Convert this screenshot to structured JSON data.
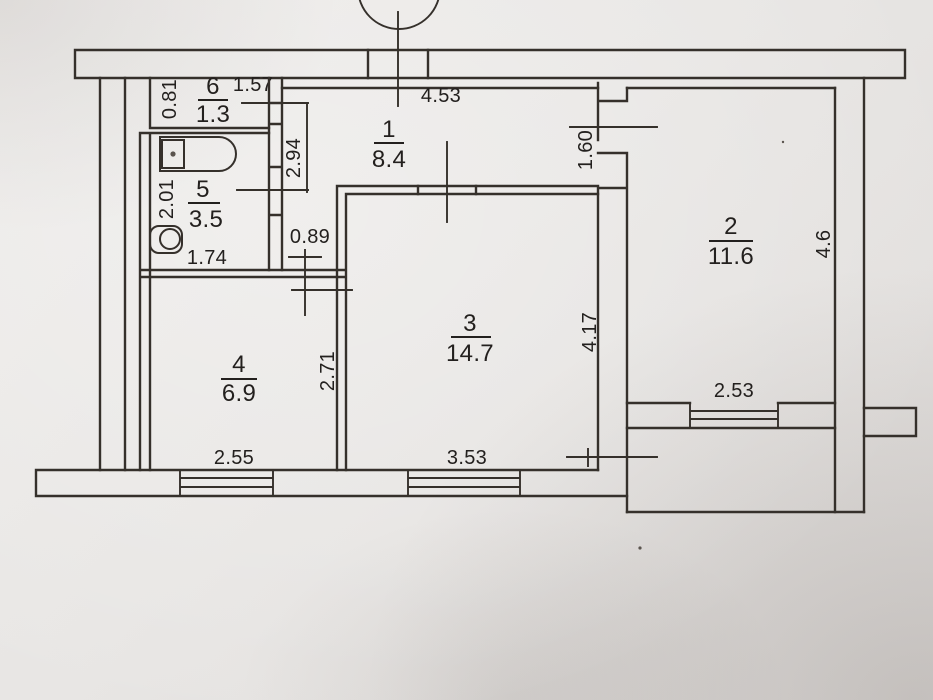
{
  "plan_title": "apartment floor plan",
  "rooms": {
    "r1": {
      "number": "1",
      "area": "8.4"
    },
    "r2": {
      "number": "2",
      "area": "11.6"
    },
    "r3": {
      "number": "3",
      "area": "14.7"
    },
    "r4": {
      "number": "4",
      "area": "6.9"
    },
    "r5": {
      "number": "5",
      "area": "3.5"
    },
    "r6": {
      "number": "6",
      "area": "1.3"
    }
  },
  "dims": {
    "hall_top_width": "4.53",
    "room6_width": "1.57",
    "room6_depth": "0.81",
    "hall_side": "2.94",
    "bath_depth": "2.01",
    "bath_width": "1.74",
    "room4_door_width": "0.89",
    "room2_door_width": "1.60",
    "room2_depth": "4.6",
    "room2_width": "2.53",
    "room3_depth": "4.17",
    "room3_width": "3.53",
    "room4_depth": "2.71",
    "room4_width": "2.55"
  },
  "icons": {
    "bathtub": "bathtub-top-view",
    "toilet": "toilet-top-view",
    "entrance_door": "door-axis-mark-with-circle",
    "window": "triple-line-window-symbol"
  },
  "colors": {
    "paper": "#e9e6e3",
    "ink": "#35302b",
    "text": "#23201e"
  }
}
